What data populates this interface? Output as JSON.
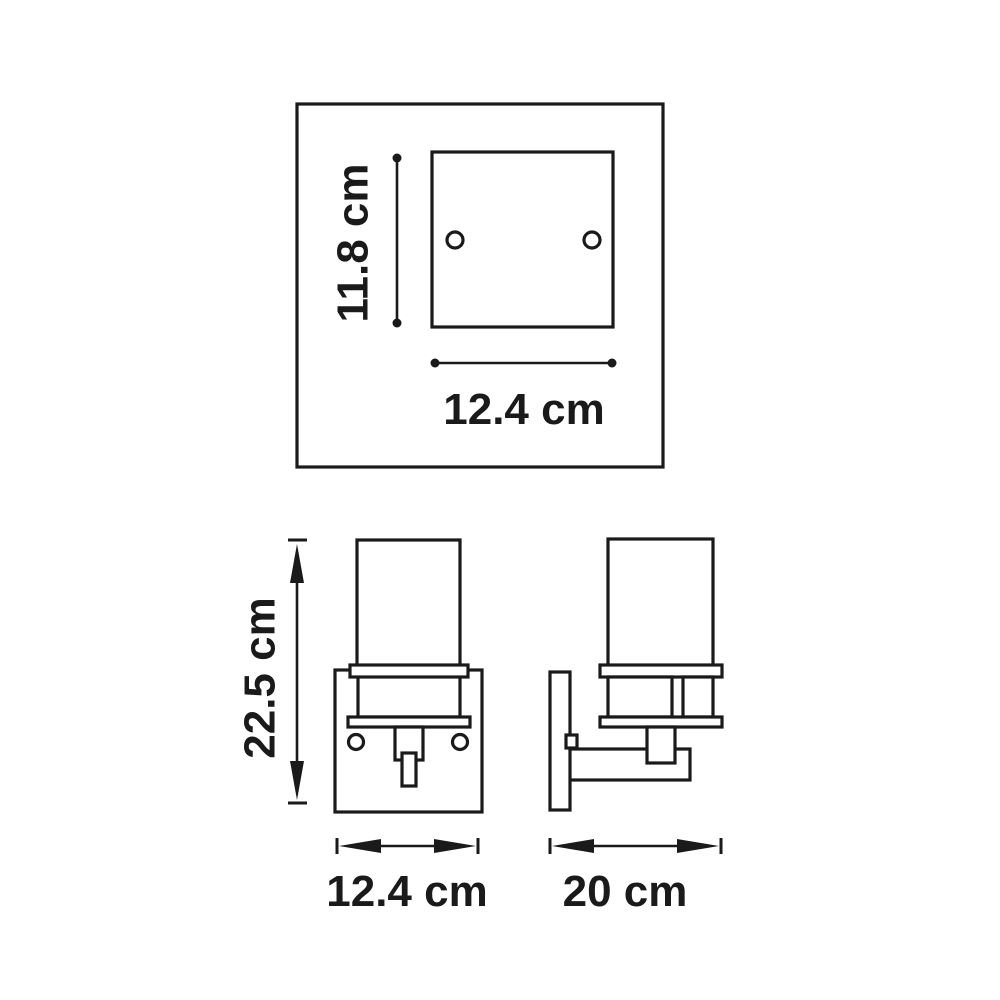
{
  "diagram": {
    "type": "technical-dimension-drawing",
    "subject": "wall sconce light fixture",
    "top_view": {
      "plate_height_label": "11.8 cm",
      "plate_width_label": "12.4 cm",
      "mounting_holes": 2
    },
    "front_view": {
      "fixture_height_label": "22.5 cm",
      "fixture_width_label": "12.4 cm",
      "mounting_screws": 2
    },
    "side_view": {
      "fixture_depth_label": "20 cm"
    },
    "colors": {
      "line": "#1a1a1a",
      "background": "#ffffff"
    }
  }
}
